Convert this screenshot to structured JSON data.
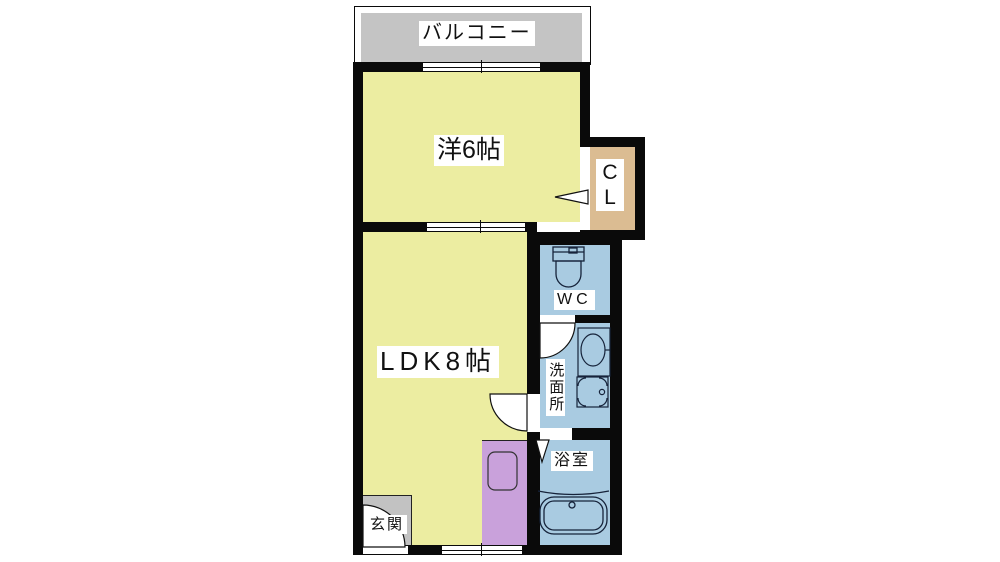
{
  "colors": {
    "wall": "#0a0a0a",
    "room_yellow": "#ECEDA1",
    "wet_blue": "#A9CBE1",
    "closet_tan": "#DBBC92",
    "kitchen_purple": "#C9A1DB",
    "balcony_gray": "#C4C4C4",
    "entrance_gray": "#C2C2C2"
  },
  "rooms": {
    "balcony": {
      "label": "バルコニー"
    },
    "bedroom": {
      "label": "洋6帖"
    },
    "closet": {
      "line1": "C",
      "line2": "L"
    },
    "ldk": {
      "label": "LDK8帖"
    },
    "wc": {
      "label": "WC"
    },
    "washroom": {
      "label": "洗面所"
    },
    "bathroom": {
      "label": "浴室"
    },
    "entrance": {
      "label": "玄関"
    }
  }
}
